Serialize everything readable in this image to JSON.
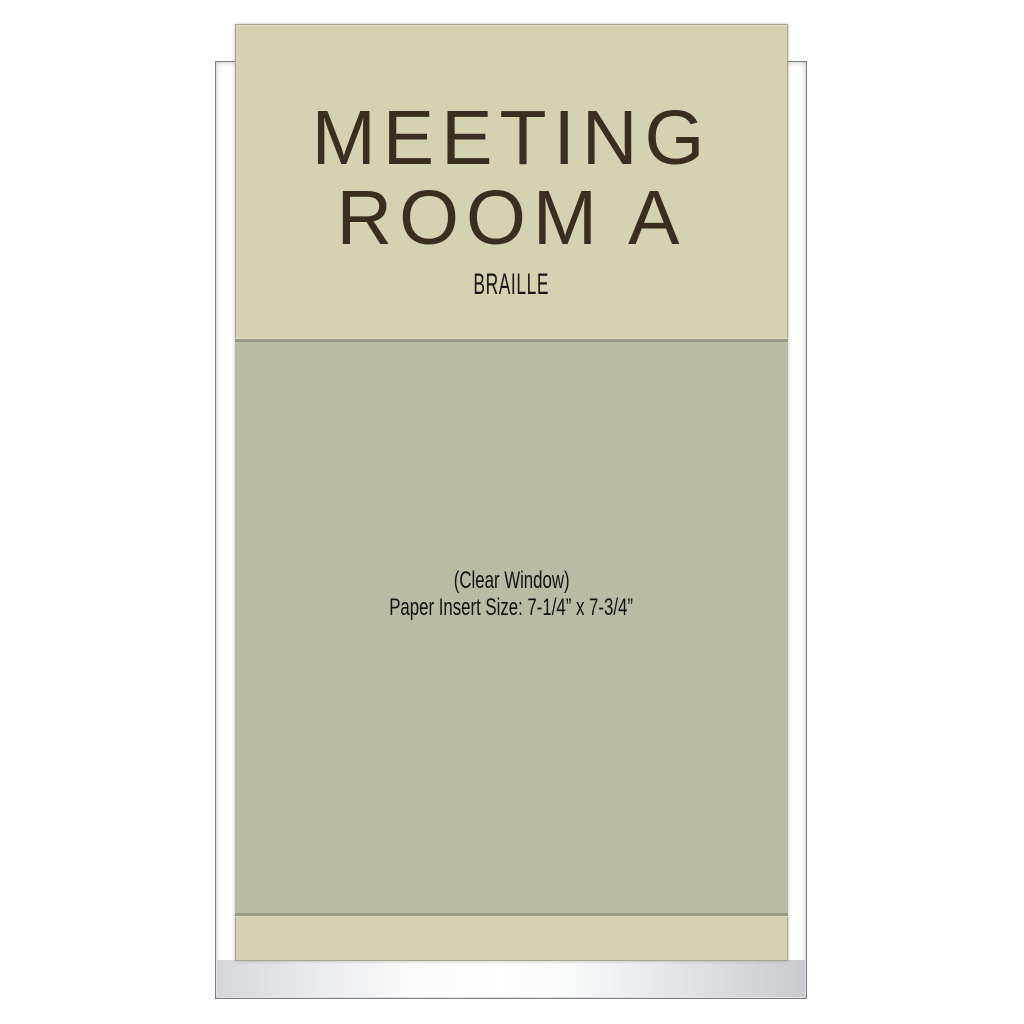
{
  "sign": {
    "title_line1": "MEETING",
    "title_line2": "ROOM A",
    "braille_label": "BRAILLE",
    "window": {
      "caption_line1": "(Clear Window)",
      "caption_line2": "Paper Insert Size: 7-1/4” x 7-3/4”"
    }
  },
  "colors": {
    "panel_beige": "#d5d2b1",
    "window_gray_green": "#babba5",
    "frame_silver": "#c5c8ce",
    "frame_edge": "#797c82",
    "title_brown": "#3a2e20",
    "text_black": "#161616",
    "background": "#ffffff"
  }
}
